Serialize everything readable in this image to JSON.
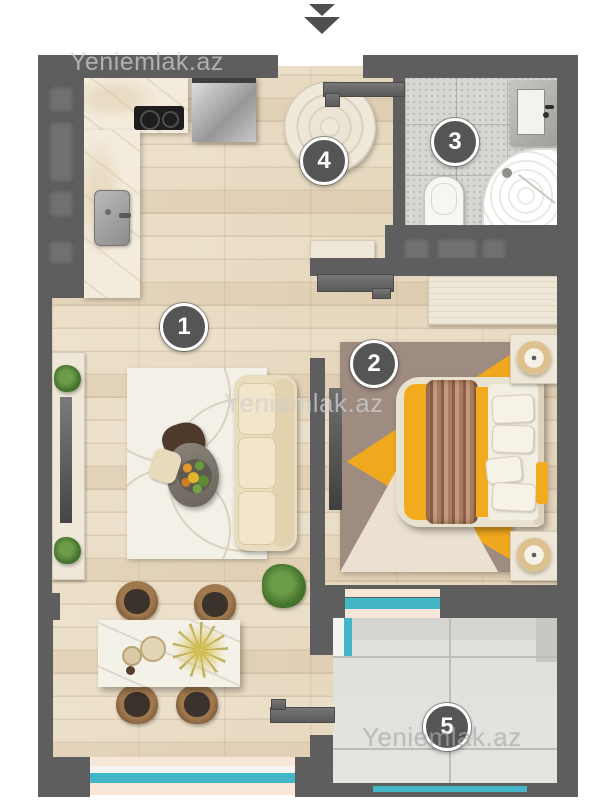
{
  "watermark": {
    "text": "Yeniemlak.az"
  },
  "entrance": {
    "marker": "double-chevron-down"
  },
  "rooms": [
    {
      "label": "1"
    },
    {
      "label": "2"
    },
    {
      "label": "3"
    },
    {
      "label": "4"
    },
    {
      "label": "5"
    }
  ],
  "colors": {
    "wall": "#5e5e5e",
    "wood_floor": "#e8dcc6",
    "bath_tile": "#d8d7d2",
    "balcony_floor": "#e2e2df",
    "window_teal": "#43b6c7",
    "window_sill": "#f8e7d9",
    "marble_counter": "#f3ecdd",
    "bedroom_rug": "#9e8c81",
    "accent_yellow": "#f2ab1e",
    "badge_fill": "#555555"
  }
}
